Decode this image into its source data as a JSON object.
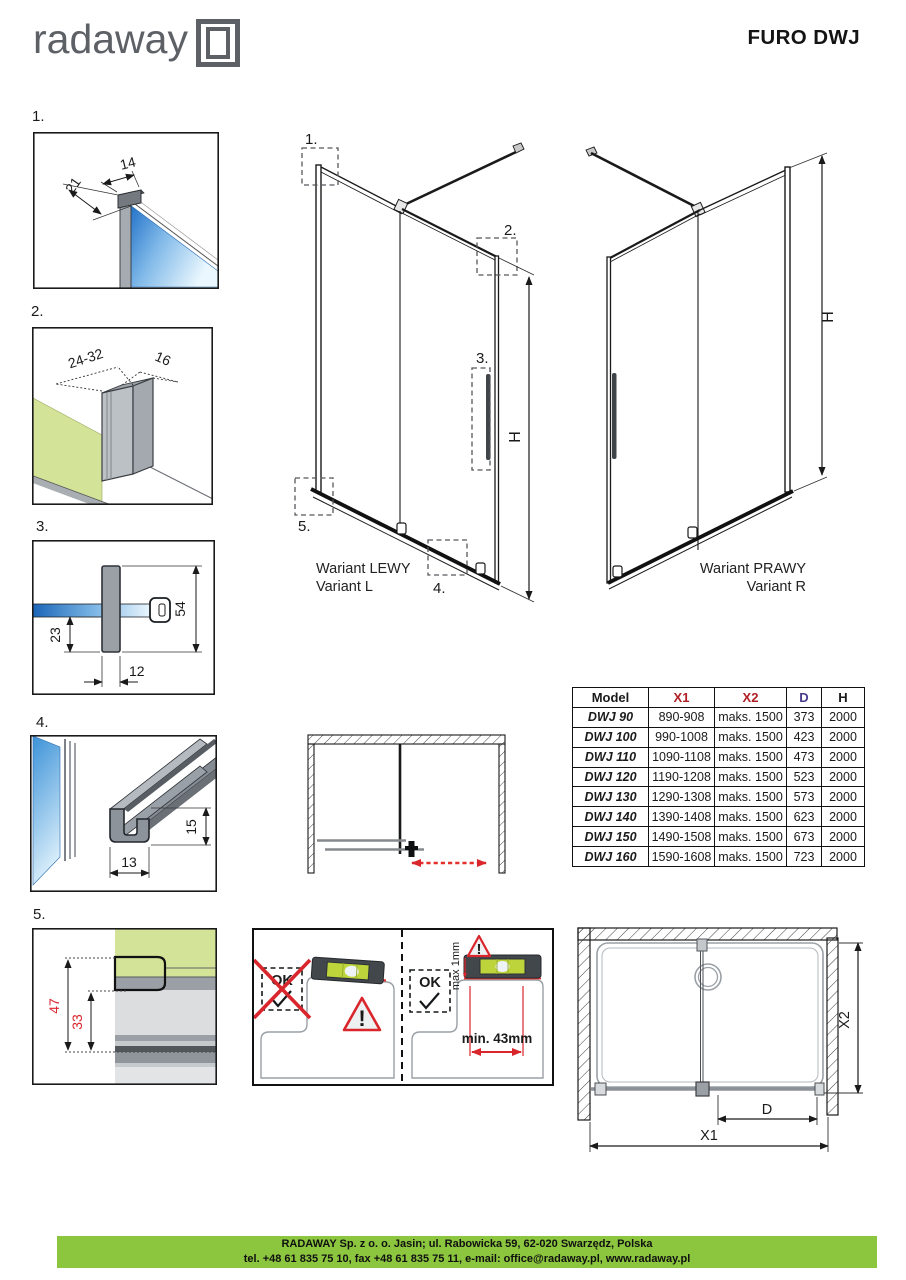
{
  "header": {
    "brand": "radaway",
    "title": "FURO DWJ"
  },
  "callouts": {
    "c1": "1.",
    "c2": "2.",
    "c3": "3.",
    "c4": "4.",
    "c5": "5."
  },
  "details": {
    "d1": {
      "num": "1.",
      "dim_width": "14",
      "dim_depth": "21"
    },
    "d2": {
      "num": "2.",
      "dim_range": "24-32",
      "dim_depth": "16"
    },
    "d3": {
      "num": "3.",
      "dim_height": "54",
      "dim_lower": "23",
      "dim_width": "12"
    },
    "d4": {
      "num": "4.",
      "dim_height": "15",
      "dim_width": "13"
    },
    "d5": {
      "num": "5.",
      "dim_outer": "47",
      "dim_inner": "33"
    }
  },
  "variants": {
    "left": {
      "name_pl": "Wariant LEWY",
      "name_en": "Variant L",
      "height_label": "H"
    },
    "right": {
      "name_pl": "Wariant PRAWY",
      "name_en": "Variant R",
      "height_label": "H"
    }
  },
  "installation": {
    "wrong_label": "OK",
    "ok_label": "OK",
    "warning_mark": "!",
    "max_gap": "max 1mm",
    "min_distance": "min. 43mm"
  },
  "plan": {
    "x1": "X1",
    "x2": "X2",
    "d": "D"
  },
  "table": {
    "headers": [
      {
        "label": "Model"
      },
      {
        "label": "X1"
      },
      {
        "label": "X2"
      },
      {
        "label": "D"
      },
      {
        "label": "H"
      }
    ],
    "rows": [
      {
        "model": "DWJ 90",
        "x1": "890-908",
        "x2": "maks. 1500",
        "d": "373",
        "h": "2000"
      },
      {
        "model": "DWJ 100",
        "x1": "990-1008",
        "x2": "maks. 1500",
        "d": "423",
        "h": "2000"
      },
      {
        "model": "DWJ 110",
        "x1": "1090-1108",
        "x2": "maks. 1500",
        "d": "473",
        "h": "2000"
      },
      {
        "model": "DWJ 120",
        "x1": "1190-1208",
        "x2": "maks. 1500",
        "d": "523",
        "h": "2000"
      },
      {
        "model": "DWJ 130",
        "x1": "1290-1308",
        "x2": "maks. 1500",
        "d": "573",
        "h": "2000"
      },
      {
        "model": "DWJ 140",
        "x1": "1390-1408",
        "x2": "maks. 1500",
        "d": "623",
        "h": "2000"
      },
      {
        "model": "DWJ 150",
        "x1": "1490-1508",
        "x2": "maks. 1500",
        "d": "673",
        "h": "2000"
      },
      {
        "model": "DWJ 160",
        "x1": "1590-1608",
        "x2": "maks. 1500",
        "d": "723",
        "h": "2000"
      }
    ]
  },
  "footer": {
    "line1": "RADAWAY Sp. z o. o. Jasin; ul. Rabowicka 59, 62-020 Swarzędz, Polska",
    "line2": "tel. +48 61 835 75 10, fax +48 61 835 75 11, e-mail: office@radaway.pl, www.radaway.pl"
  },
  "colors": {
    "brand_green": "#8cc63f",
    "accent_red": "#d9262c",
    "table_red": "#b02025",
    "table_purple": "#4a3c8c",
    "glass_blue": "#2577cc",
    "wall_green": "#d3e398",
    "profile_gray": "#9aa0a6",
    "logo_gray": "#5d6166"
  }
}
